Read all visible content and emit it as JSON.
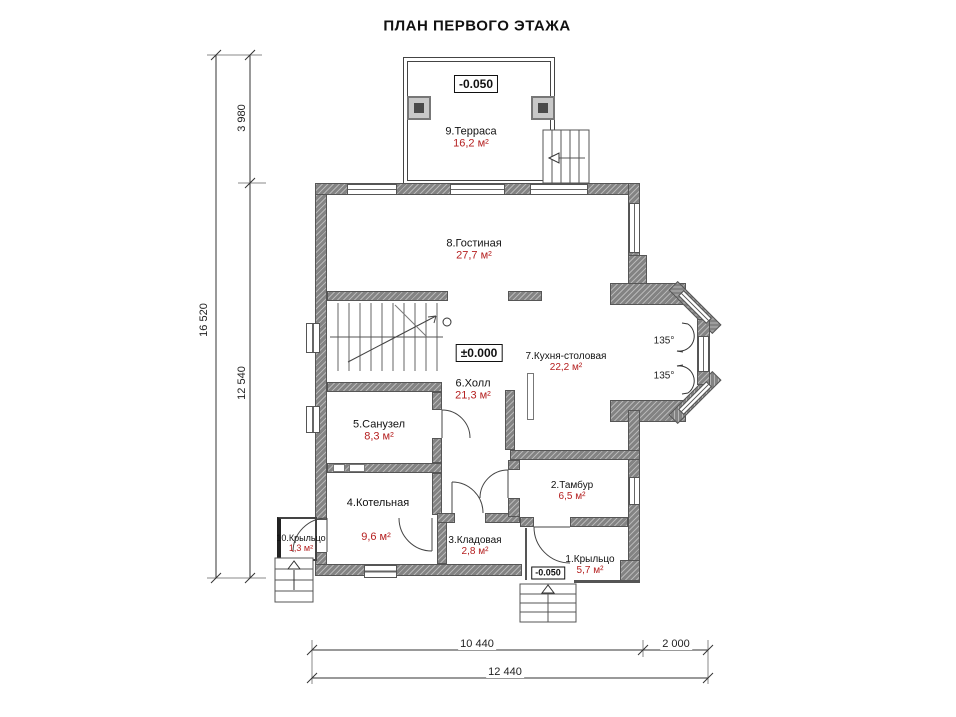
{
  "title": "ПЛАН ПЕРВОГО ЭТАЖА",
  "rooms": [
    {
      "name": "1.Крыльцо",
      "area": "5,7 м²"
    },
    {
      "name": "2.Тамбур",
      "area": "6,5 м²"
    },
    {
      "name": "3.Кладовая",
      "area": "2,8 м²"
    },
    {
      "name": "4.Котельная",
      "area": "9,6 м²"
    },
    {
      "name": "5.Санузел",
      "area": "8,3 м²"
    },
    {
      "name": "6.Холл",
      "area": "21,3 м²"
    },
    {
      "name": "7.Кухня-столовая",
      "area": "22,2 м²"
    },
    {
      "name": "8.Гостиная",
      "area": "27,7 м²"
    },
    {
      "name": "9.Терраса",
      "area": "16,2 м²"
    },
    {
      "name": "10.Крыльцо",
      "area": "1,3 м²"
    }
  ],
  "levels": {
    "terrace": "-0.050",
    "main": "±0.000",
    "porch": "-0.050"
  },
  "dimensions": {
    "vertical_total": "16 520",
    "vertical_terrace": "3 980",
    "vertical_main": "12 540",
    "horizontal_main": "10 440",
    "horizontal_bay": "2 000",
    "horizontal_total": "12 440"
  },
  "angles": {
    "bay_upper": "135°",
    "bay_lower": "135°"
  },
  "colors": {
    "wall": "#838383",
    "area_text": "#b52020",
    "line": "#333333"
  }
}
